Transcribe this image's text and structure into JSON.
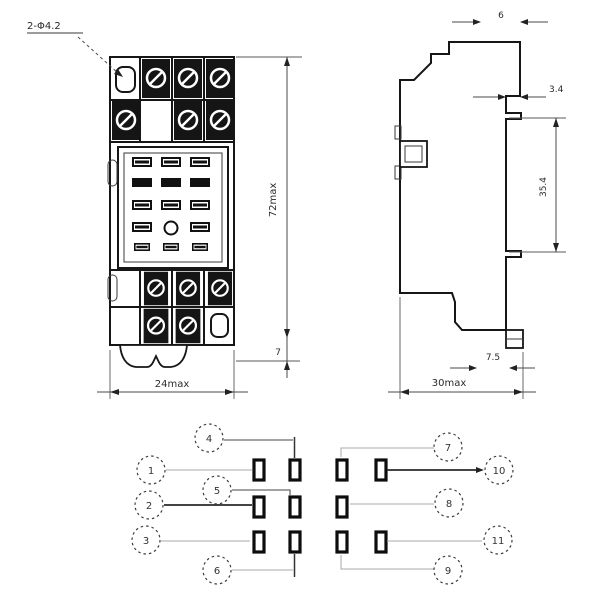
{
  "drawing": {
    "type": "relay-socket-outline-and-terminal-diagram",
    "views": [
      "front-view",
      "side-view",
      "terminal-arrangement"
    ]
  },
  "dimensions": {
    "mounting_holes": "2-Φ4.2",
    "front_height": "72max",
    "front_foot_height": "7",
    "front_width": "24max",
    "side_top_tab": "6",
    "side_hook": "3.4",
    "side_rail_height": "35.4",
    "side_clip": "7.5",
    "side_depth": "30max"
  },
  "schematic": {
    "pins": [
      {
        "n": "1"
      },
      {
        "n": "4"
      },
      {
        "n": "7"
      },
      {
        "n": "10"
      },
      {
        "n": "2"
      },
      {
        "n": "5"
      },
      {
        "n": "8"
      },
      {
        "n": "3"
      },
      {
        "n": "6"
      },
      {
        "n": "9"
      },
      {
        "n": "11"
      }
    ]
  }
}
